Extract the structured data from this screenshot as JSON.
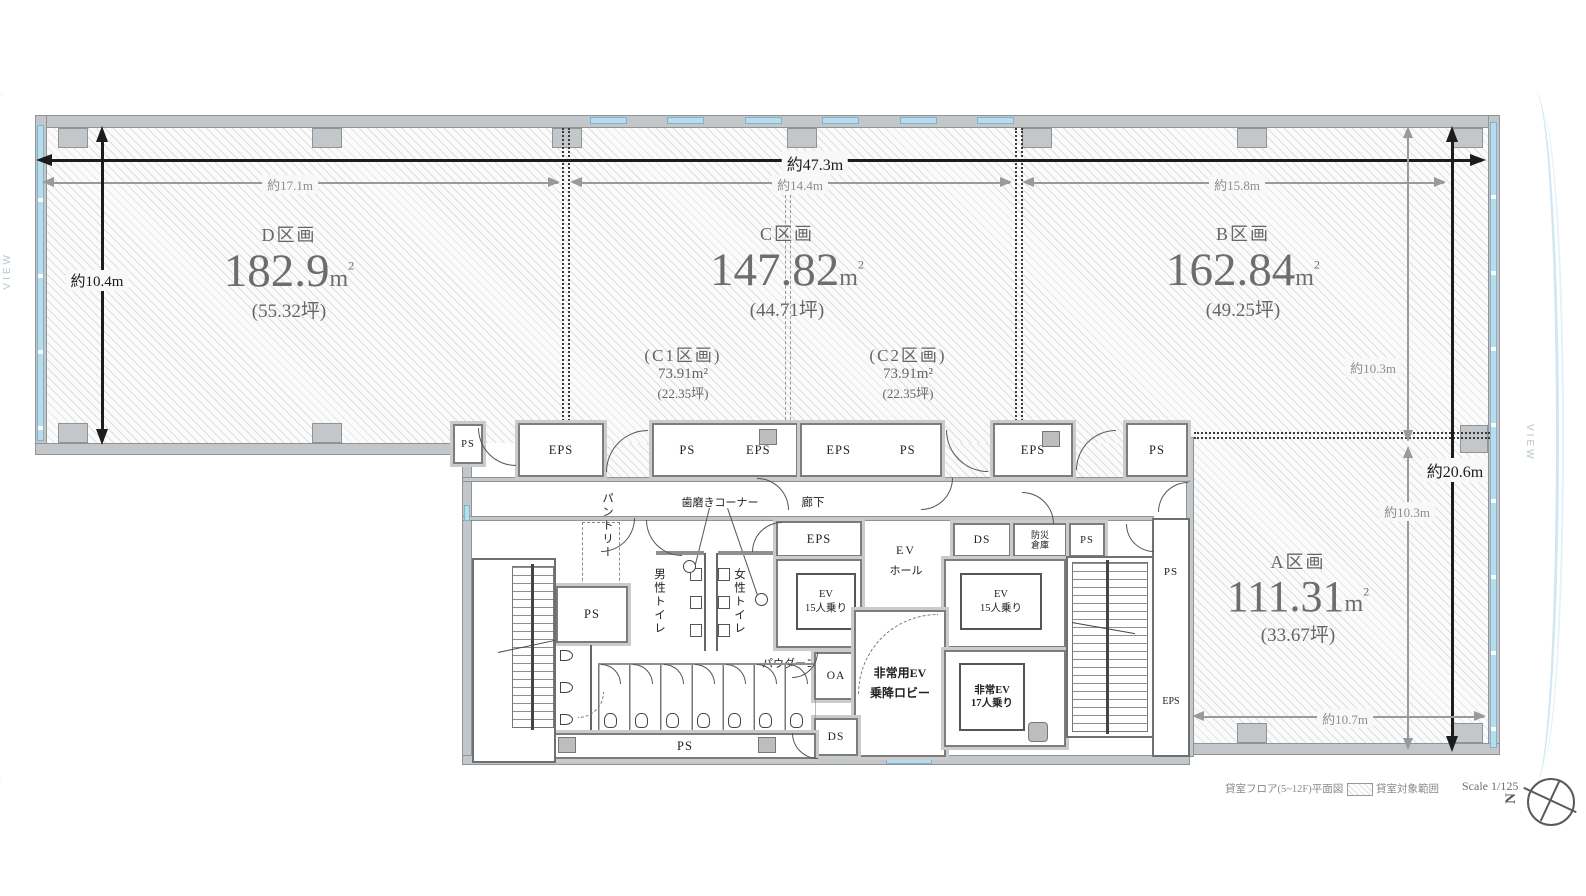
{
  "sections": {
    "d": {
      "name": "D区画",
      "area": "182.9",
      "unit": "m",
      "unit_sup": "2",
      "tsubo": "(55.32坪)"
    },
    "c": {
      "name": "C区画",
      "area": "147.82",
      "unit": "m",
      "unit_sup": "2",
      "tsubo": "(44.71坪)"
    },
    "c1": {
      "name": "(C1区画)",
      "area": "73.91m²",
      "tsubo": "(22.35坪)"
    },
    "c2": {
      "name": "(C2区画)",
      "area": "73.91m²",
      "tsubo": "(22.35坪)"
    },
    "b": {
      "name": "B区画",
      "area": "162.84",
      "unit": "m",
      "unit_sup": "2",
      "tsubo": "(49.25坪)"
    },
    "a": {
      "name": "A区画",
      "area": "111.31",
      "unit": "m",
      "unit_sup": "2",
      "tsubo": "(33.67坪)"
    }
  },
  "dimensions": {
    "total_width": "約47.3m",
    "d_width": "約17.1m",
    "c_width": "約14.4m",
    "b_width": "約15.8m",
    "d_height": "約10.4m",
    "b_height": "約10.3m",
    "a_height": "約10.3m",
    "total_height": "約20.6m",
    "a_width": "約10.7m"
  },
  "labels": {
    "ps": "PS",
    "eps": "EPS",
    "ds": "DS",
    "oa": "OA",
    "bousai": "防災\n倉庫",
    "pantry": "パントリー",
    "mens": "男性トイレ",
    "womens": "女性トイレ",
    "toothbrush": "歯磨きコーナー",
    "corridor": "廊下",
    "powder": "パウダーコーナー",
    "ev_hall_1": "EV",
    "ev_hall_2": "ホール",
    "ev15_1": "EV",
    "ev15_2": "15人乗り",
    "lobby_1": "非常用EV",
    "lobby_2": "乗降ロビー",
    "ev17_1": "非常EV",
    "ev17_2": "17人乗り"
  },
  "view": {
    "left": "VIEW",
    "right": "VIEW"
  },
  "footer": {
    "plan_title": "貸室フロア(5~12F)平面図",
    "legend_label": "貸室対象範囲",
    "scale": "Scale 1/125",
    "compass_n": "N"
  },
  "colors": {
    "window": "#b8dcec",
    "wall": "#c3c7c9",
    "dim_black": "#1c1c1c",
    "dim_gray": "#9a9a9a",
    "text_gray": "#6d6d6d"
  }
}
